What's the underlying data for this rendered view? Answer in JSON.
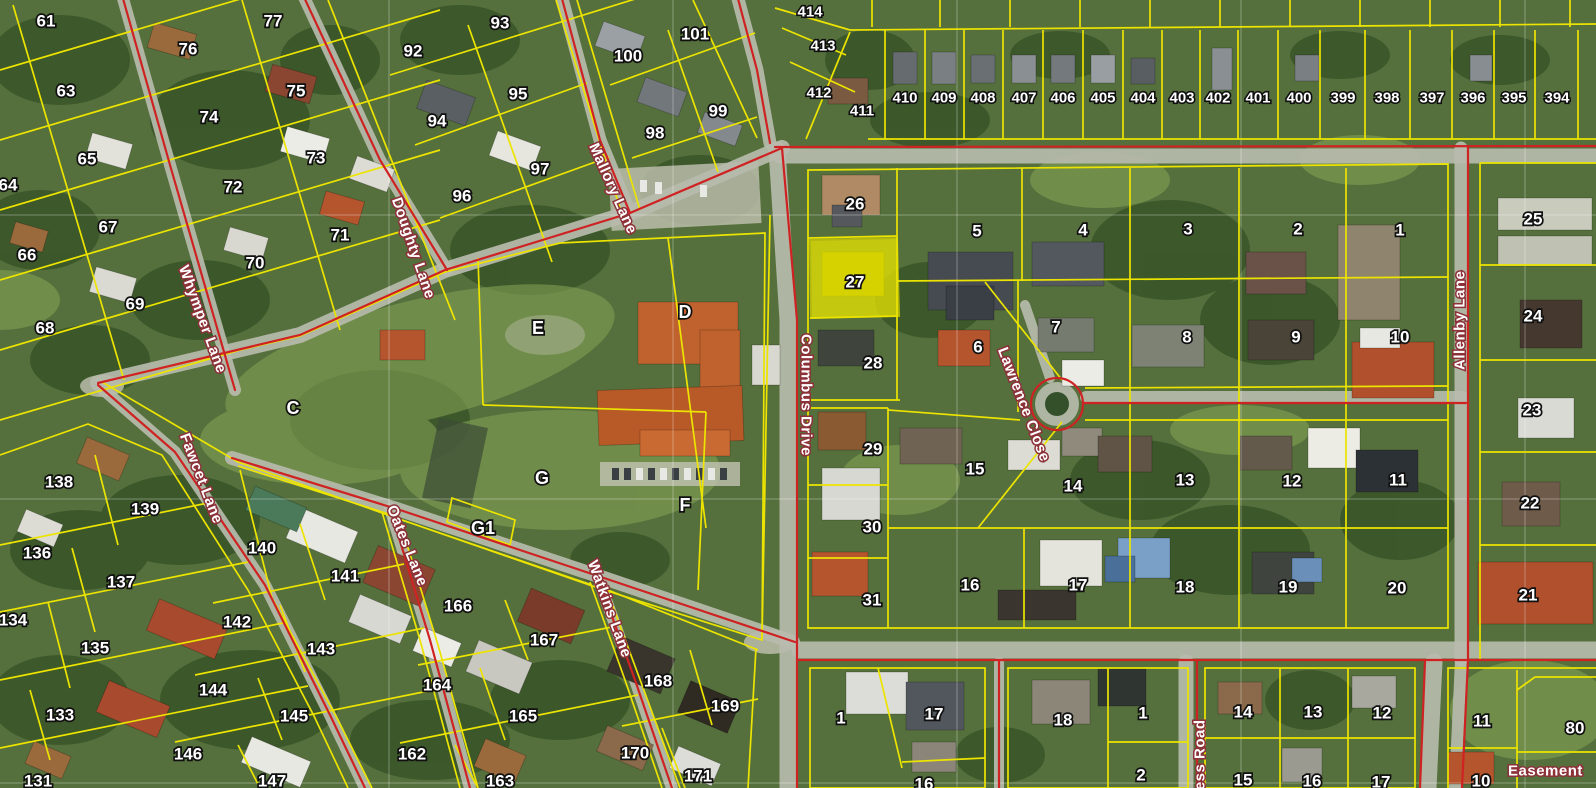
{
  "map": {
    "type": "cadastral-aerial-map",
    "highlighted_parcel": "27",
    "colors": {
      "parcel_line": "#ece400",
      "road_line": "#cf2222",
      "highlight_fill": "#f0ec00",
      "label_fill": "#ffffff"
    },
    "streets": {
      "whymper": "Whymper Lane",
      "doughty": "Doughty Lane",
      "mallory": "Mallory Lane",
      "fawcet": "Fawcet Lane",
      "oates": "Oates Lane",
      "watkins": "Watkins Lane",
      "columbus": "Columbus Drive",
      "lawrence": "Lawrence Close",
      "allenby": "Allenby Lane",
      "cess": "cess Road",
      "easement": "Easement"
    },
    "labels": {
      "nw61": "61",
      "nw77": "77",
      "nw76": "76",
      "nw63": "63",
      "nw75": "75",
      "nw74": "74",
      "nw65": "65",
      "nw73": "73",
      "nw64": "64",
      "nw72": "72",
      "nw67": "67",
      "nw71": "71",
      "nw66": "66",
      "nw70": "70",
      "nw69": "69",
      "nw68": "68",
      "nm93": "93",
      "nm92": "92",
      "nm101": "101",
      "nm100": "100",
      "nm95": "95",
      "nm94": "94",
      "nm99": "99",
      "nm98": "98",
      "nm97": "97",
      "nm96": "96",
      "fan414": "414",
      "fan413": "413",
      "fan412": "412",
      "fan411": "411",
      "st410": "410",
      "st409": "409",
      "st408": "408",
      "st407": "407",
      "st406": "406",
      "st405": "405",
      "st404": "404",
      "st403": "403",
      "st402": "402",
      "st401": "401",
      "st400": "400",
      "st399": "399",
      "st398": "398",
      "st397": "397",
      "st396": "396",
      "st395": "395",
      "st394": "394",
      "mb26": "26",
      "mb27": "27",
      "mb28": "28",
      "mb29": "29",
      "mb30": "30",
      "mb31": "31",
      "mb5": "5",
      "mb4": "4",
      "mb3": "3",
      "mb2": "2",
      "mb1": "1",
      "mb6": "6",
      "mb7": "7",
      "mb8": "8",
      "mb9": "9",
      "mb10": "10",
      "mb15": "15",
      "mb14": "14",
      "mb13": "13",
      "mb12": "12",
      "mb11": "11",
      "mb16": "16",
      "mb17": "17",
      "mb18": "18",
      "mb19": "19",
      "mb20": "20",
      "ne25": "25",
      "ne24": "24",
      "ne23": "23",
      "ne22": "22",
      "ne21": "21",
      "sw138": "138",
      "sw139": "139",
      "sw136": "136",
      "sw137": "137",
      "sw134": "134",
      "sw135": "135",
      "sw133": "133",
      "sw131": "131",
      "sm140": "140",
      "sm141": "141",
      "sm142": "142",
      "sm143": "143",
      "sm144": "144",
      "sm145": "145",
      "sm146": "146",
      "sm147": "147",
      "so166": "166",
      "so167": "167",
      "so164": "164",
      "so165": "165",
      "so162": "162",
      "so163": "163",
      "sk168": "168",
      "sk169": "169",
      "sk170": "170",
      "sk171": "171",
      "ss1a": "1",
      "ss17a": "17",
      "ss16a": "16",
      "ss18": "18",
      "ss1b": "1",
      "ss2": "2",
      "ss14": "14",
      "ss13": "13",
      "ss12": "12",
      "ss15": "15",
      "ss16b": "16",
      "ss17b": "17",
      "ss11": "11",
      "ss80": "80",
      "ss10": "10",
      "letC": "C",
      "letD": "D",
      "letE": "E",
      "letG": "G",
      "letG1": "G1",
      "letF": "F"
    }
  }
}
